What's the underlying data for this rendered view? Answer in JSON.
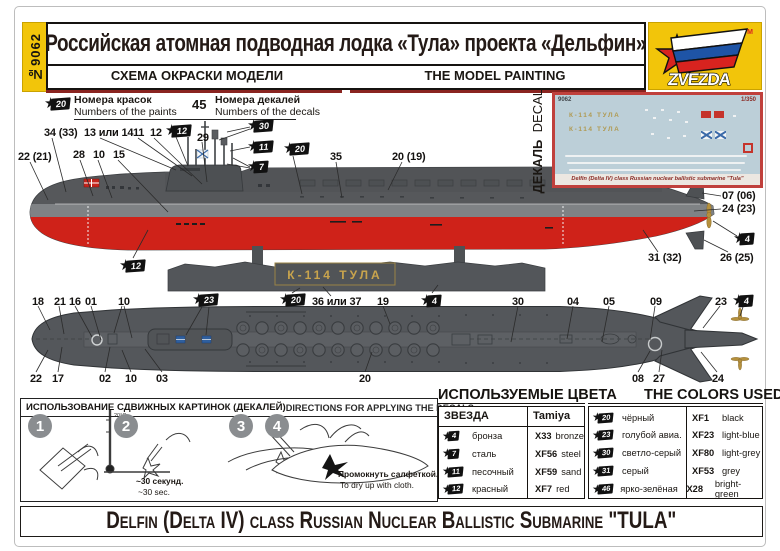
{
  "header": {
    "product_no": "№9062",
    "title": "Российская атомная подводная лодка «Тула» проекта «Дельфин»",
    "subtitle_ru": "СХЕМА ОКРАСКИ МОДЕЛИ",
    "subtitle_en": "THE MODEL PAINTING",
    "brand": "ZVEZDA",
    "tm": "TM"
  },
  "legend": {
    "paint_flag_num": "20",
    "paints_ru": "Номера красок",
    "paints_en": "Numbers of the paints",
    "decal_number": "45",
    "decals_ru": "Номера декалей",
    "decals_en": "Numbers of the decals"
  },
  "decal_panel": {
    "label_ru": "ДЕКАЛЬ",
    "label_en": "DECAL",
    "sheet_no": "9062",
    "scale": "1/350",
    "boat_name": "К-114 ТУЛА",
    "caption": "Delfin (Delta IV) class Russian nuclear ballistic submarine \"Tula\""
  },
  "side_view": {
    "stand_plate": "К-114 ТУЛА",
    "callouts": [
      {
        "label": "22 (21)",
        "x": 18,
        "y": 151
      },
      {
        "label": "34 (33)",
        "x": 44,
        "y": 127
      },
      {
        "label": "13 или 14",
        "x": 84,
        "y": 127
      },
      {
        "label": "11",
        "x": 133,
        "y": 127
      },
      {
        "label": "12",
        "x": 150,
        "y": 127
      },
      {
        "label": "28",
        "x": 73,
        "y": 149
      },
      {
        "label": "10",
        "x": 93,
        "y": 149
      },
      {
        "label": "15",
        "x": 113,
        "y": 149
      },
      {
        "label": "29",
        "x": 197,
        "y": 132
      },
      {
        "label": "35",
        "x": 330,
        "y": 151
      },
      {
        "label": "20 (19)",
        "x": 392,
        "y": 151
      },
      {
        "label": "07 (06)",
        "x": 722,
        "y": 190
      },
      {
        "label": "24 (23)",
        "x": 722,
        "y": 203
      },
      {
        "label": "31 (32)",
        "x": 648,
        "y": 252
      },
      {
        "label": "26 (25)",
        "x": 720,
        "y": 252
      }
    ],
    "flags": [
      {
        "num": "12",
        "x": 165,
        "y": 124
      },
      {
        "num": "30",
        "x": 247,
        "y": 119
      },
      {
        "num": "11",
        "x": 247,
        "y": 140
      },
      {
        "num": "7",
        "x": 247,
        "y": 160
      },
      {
        "num": "20",
        "x": 283,
        "y": 142
      },
      {
        "num": "4",
        "x": 733,
        "y": 232
      },
      {
        "num": "12",
        "x": 119,
        "y": 259
      }
    ]
  },
  "top_view": {
    "callouts": [
      {
        "label": "18",
        "x": 32,
        "y": 296
      },
      {
        "label": "21",
        "x": 54,
        "y": 296
      },
      {
        "label": "16",
        "x": 69,
        "y": 296
      },
      {
        "label": "01",
        "x": 85,
        "y": 296
      },
      {
        "label": "10",
        "x": 118,
        "y": 296
      },
      {
        "label": "36 или 37",
        "x": 312,
        "y": 296
      },
      {
        "label": "19",
        "x": 377,
        "y": 296
      },
      {
        "label": "30",
        "x": 512,
        "y": 296
      },
      {
        "label": "04",
        "x": 567,
        "y": 296
      },
      {
        "label": "05",
        "x": 603,
        "y": 296
      },
      {
        "label": "09",
        "x": 650,
        "y": 296
      },
      {
        "label": "23",
        "x": 715,
        "y": 296
      },
      {
        "label": "22",
        "x": 30,
        "y": 373
      },
      {
        "label": "17",
        "x": 52,
        "y": 373
      },
      {
        "label": "02",
        "x": 99,
        "y": 373
      },
      {
        "label": "10",
        "x": 125,
        "y": 373
      },
      {
        "label": "03",
        "x": 156,
        "y": 373
      },
      {
        "label": "20",
        "x": 359,
        "y": 373
      },
      {
        "label": "08",
        "x": 632,
        "y": 373
      },
      {
        "label": "27",
        "x": 653,
        "y": 373
      },
      {
        "label": "24",
        "x": 712,
        "y": 373
      }
    ],
    "flags": [
      {
        "num": "23",
        "x": 192,
        "y": 293
      },
      {
        "num": "20",
        "x": 279,
        "y": 293
      },
      {
        "num": "4",
        "x": 420,
        "y": 294
      },
      {
        "num": "4",
        "x": 732,
        "y": 294
      }
    ]
  },
  "directions": {
    "title_ru": "ИСПОЛЬЗОВАНИЕ СДВИЖНЫХ КАРТИНОК (ДЕКАЛЕЙ)",
    "title_en": "DIRECTIONS  FOR APPLYING THE DECALS",
    "steps": [
      "1",
      "2",
      "3",
      "4"
    ],
    "step2_temp": "20°C",
    "step2_note_ru": "~30 секунд.",
    "step2_note_en": "~30 sec.",
    "step4_note_ru": "Промокнуть салфеткой.",
    "step4_note_en": "To dry up with cloth."
  },
  "colors": {
    "title_ru": "ИСПОЛЬЗУЕМЫЕ ЦВЕТА",
    "title_en": "THE COLORS USED",
    "brand_col": "ЗВЕЗДА",
    "tamiya_col": "Tamiya",
    "left_rows": [
      {
        "num": "4",
        "name_ru": "бронза",
        "code": "X33",
        "name_en": "bronze"
      },
      {
        "num": "7",
        "name_ru": "сталь",
        "code": "XF56",
        "name_en": "steel"
      },
      {
        "num": "11",
        "name_ru": "песочный",
        "code": "XF59",
        "name_en": "sand"
      },
      {
        "num": "12",
        "name_ru": "красный",
        "code": "XF7",
        "name_en": "red"
      }
    ],
    "right_rows": [
      {
        "num": "20",
        "name_ru": "чёрный",
        "code": "XF1",
        "name_en": "black"
      },
      {
        "num": "23",
        "name_ru": "голубой авиа.",
        "code": "XF23",
        "name_en": "light-blue"
      },
      {
        "num": "30",
        "name_ru": "светло-серый",
        "code": "XF80",
        "name_en": "light-grey"
      },
      {
        "num": "31",
        "name_ru": "серый",
        "code": "XF53",
        "name_en": "grey"
      },
      {
        "num": "46",
        "name_ru": "ярко-зелёная",
        "code": "X28",
        "name_en": "bright-green"
      }
    ]
  },
  "footer": {
    "title": "Delfin (Delta IV) class Russian Nuclear Ballistic Submarine \"TULA\""
  },
  "palette": {
    "hull_gray": "#56585b",
    "waterline_gray": "#7f8285",
    "hull_red": "#cf2219",
    "brand_yellow": "#f2c50a",
    "accent_dark_red": "#8a2420"
  }
}
